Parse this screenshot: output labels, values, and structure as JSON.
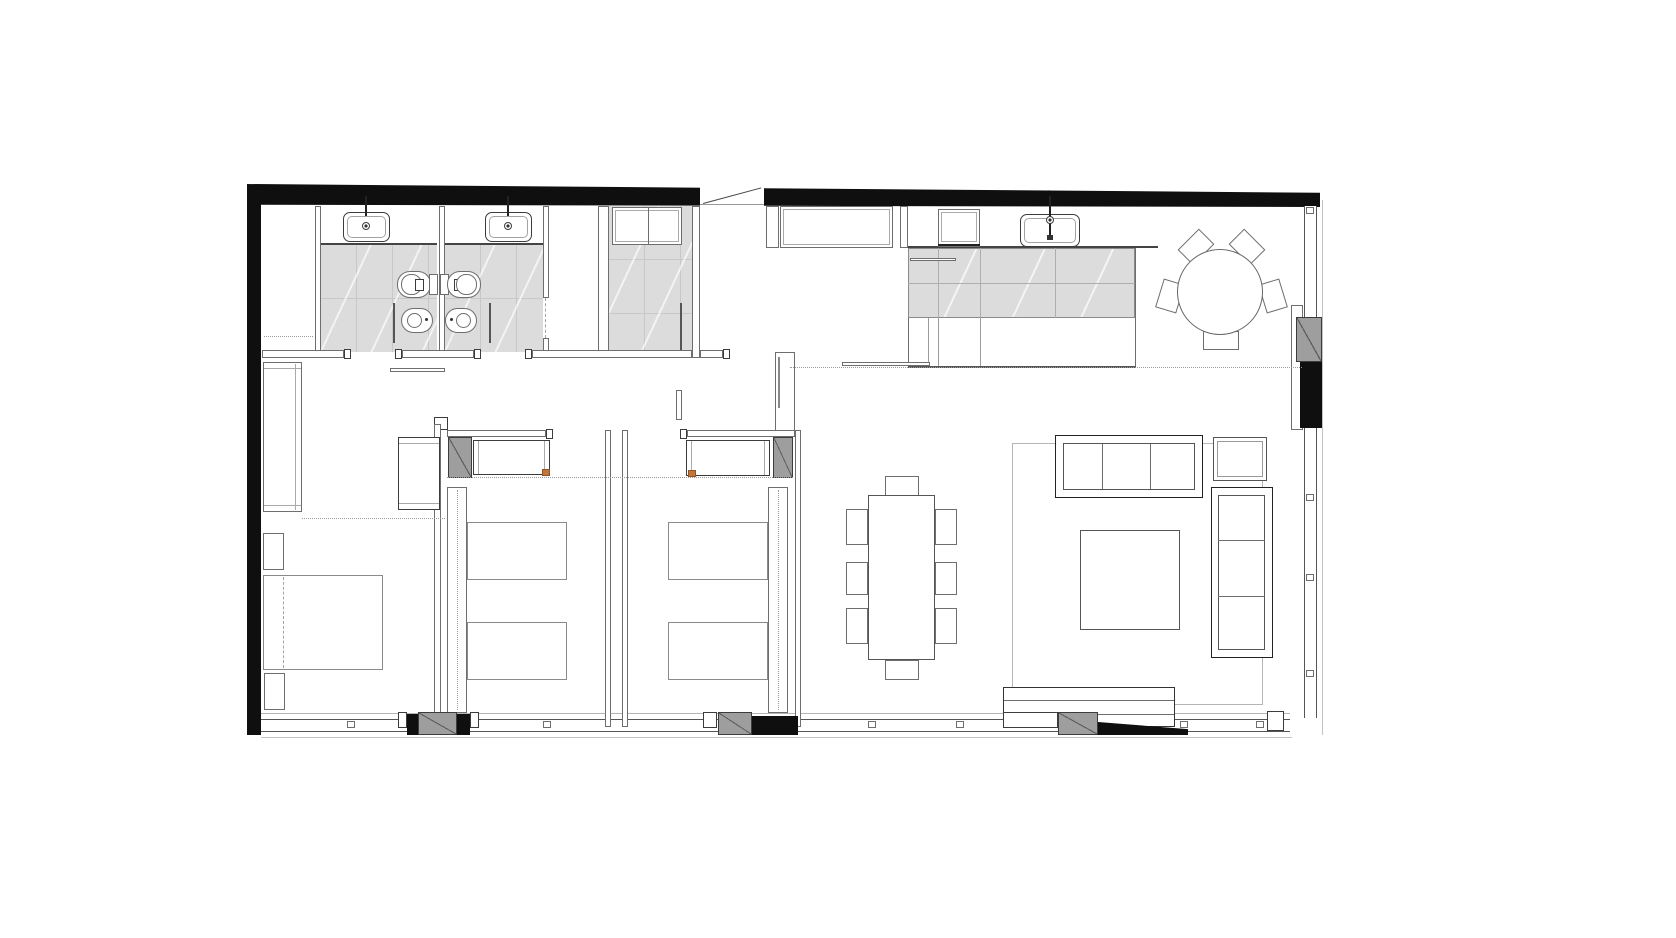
{
  "document": {
    "kind": "architectural floor plan",
    "view": "top-down plan drawing of an apartment",
    "style": "black-and-white CAD line drawing; solid black exterior walls, thin gray furniture outlines, light-gray tiled wet areas, dotted zoning lines",
    "visible_text": "none"
  },
  "colors": {
    "paper": "#ffffff",
    "wall_ink": "#0f0f0f",
    "line_dark": "#3c3c3c",
    "line": "#6e6e6e",
    "line_light": "#a3a3a3",
    "tile_fill": "#dcdcdc",
    "tile_joint": "#c8c8c8",
    "pier_gray": "#9e9e9e",
    "dotted": "#9a9a9a",
    "accent_orange": "#c0763c"
  },
  "rooms": [
    {
      "name": "storage-closet",
      "location": "top-left",
      "features": [
        "dotted shelf line"
      ]
    },
    {
      "name": "bathroom-1",
      "location": "top-left",
      "fixtures": [
        "vanity counter",
        "inset sink with faucet",
        "toilet",
        "bidet",
        "glass screen",
        "gray tiled floor"
      ]
    },
    {
      "name": "bathroom-2",
      "location": "top, mirrored twin of bathroom-1",
      "fixtures": [
        "vanity counter",
        "inset sink with faucet",
        "toilet",
        "bidet",
        "glass screen",
        "gray tiled floor"
      ]
    },
    {
      "name": "shower-room",
      "location": "top-center",
      "fixtures": [
        "dashed glass door"
      ]
    },
    {
      "name": "laundry-storage",
      "location": "top-center",
      "fixtures": [
        "two built-in cabinets",
        "door leaf",
        "gray tiled floor"
      ]
    },
    {
      "name": "entry-hall",
      "location": "top-center-right",
      "fixtures": [
        "entry door in top wall",
        "built-in wardrobe"
      ]
    },
    {
      "name": "kitchen",
      "location": "top-right",
      "fixtures": [
        "wall counter",
        "cooktop/appliance block",
        "double sink with faucet",
        "large gray island with cabinet divisions",
        "sliding-door tracks"
      ]
    },
    {
      "name": "breakfast-dining",
      "location": "top-right",
      "fixtures": [
        "round table",
        "five chairs"
      ]
    },
    {
      "name": "hallway",
      "location": "center-left band",
      "features": [
        "sliding door track",
        "door jambs",
        "dotted guide lines"
      ]
    },
    {
      "name": "master-bedroom",
      "location": "bottom-left",
      "fixtures": [
        "double bed",
        "two nightstands",
        "tall wardrobe on left wall",
        "desk/dresser",
        "dotted zone line"
      ]
    },
    {
      "name": "bedroom-2",
      "location": "bottom-center-left",
      "fixtures": [
        "two twin beds",
        "headboard side rail",
        "desk console with orange accent",
        "gray structural pier"
      ]
    },
    {
      "name": "bedroom-3",
      "location": "bottom-center, mirrored twin of bedroom-2",
      "fixtures": [
        "two twin beds",
        "headboard side rail",
        "desk console with orange accent",
        "gray structural pier"
      ]
    },
    {
      "name": "living-dining-room",
      "location": "right",
      "fixtures": [
        "eight-seat rectangular dining table",
        "three-seat sofa",
        "chaise sofa on right",
        "armchair",
        "square coffee table",
        "low bench/daybed at window",
        "area rug"
      ]
    }
  ],
  "envelope": {
    "top_wall": "solid black, slightly tapered, with entry-door opening and swing line",
    "left_wall": "solid black",
    "bottom_wall": "continuous glazing band with mullion ticks, two gray balcony piers and black infill chunks",
    "right_wall": "continuous glazing band with mullion ticks and one gray/black structural pier"
  }
}
